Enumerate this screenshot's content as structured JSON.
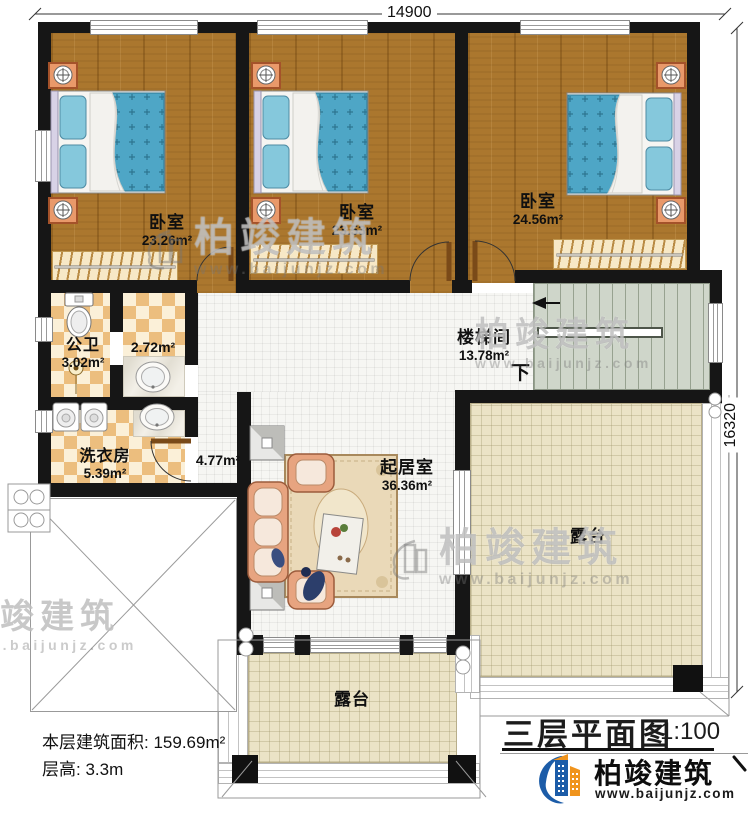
{
  "dimensions": {
    "top": "14900",
    "right": "16320"
  },
  "rooms": {
    "bedroom_left": {
      "name": "卧室",
      "area": "23.26m²"
    },
    "bedroom_middle": {
      "name": "卧室",
      "area": "23.53m²"
    },
    "bedroom_right": {
      "name": "卧室",
      "area": "24.56m²"
    },
    "public_bath": {
      "name": "公卫",
      "area": "3.02m²"
    },
    "closet": {
      "area": "2.72m²"
    },
    "laundry": {
      "name": "洗衣房",
      "area": "5.39m²"
    },
    "corridor": {
      "area": "4.77m²"
    },
    "stairwell": {
      "name": "楼梯间",
      "area": "13.78m²",
      "direction": "下"
    },
    "living_room": {
      "name": "起居室",
      "area": "36.36m²"
    },
    "terrace_right": {
      "name": "露台"
    },
    "terrace_bottom": {
      "name": "露台"
    }
  },
  "info": {
    "floor_area_label": "本层建筑面积:",
    "floor_area_value": "159.69m²",
    "floor_height_label": "层高:",
    "floor_height_value": "3.3m"
  },
  "title_block": {
    "title": "三层平面图",
    "scale": "1:100"
  },
  "brand": {
    "name": "柏竣建筑",
    "website": "www.baijunjz.com"
  },
  "watermark": {
    "name": "柏竣建筑",
    "website": "www.baijunjz.com"
  },
  "colors": {
    "wall": "#161616",
    "wood_floor": "#ab772e",
    "checker_tile": "#ecbe7e",
    "terrace_floor": "#ebe3c6",
    "stair_floor": "#cfd6ca",
    "bed_blue": "#4ea6c6",
    "nightstand_orange": "#e9996a",
    "brand_blue": "#1c5ca8",
    "brand_orange": "#f0941d"
  }
}
